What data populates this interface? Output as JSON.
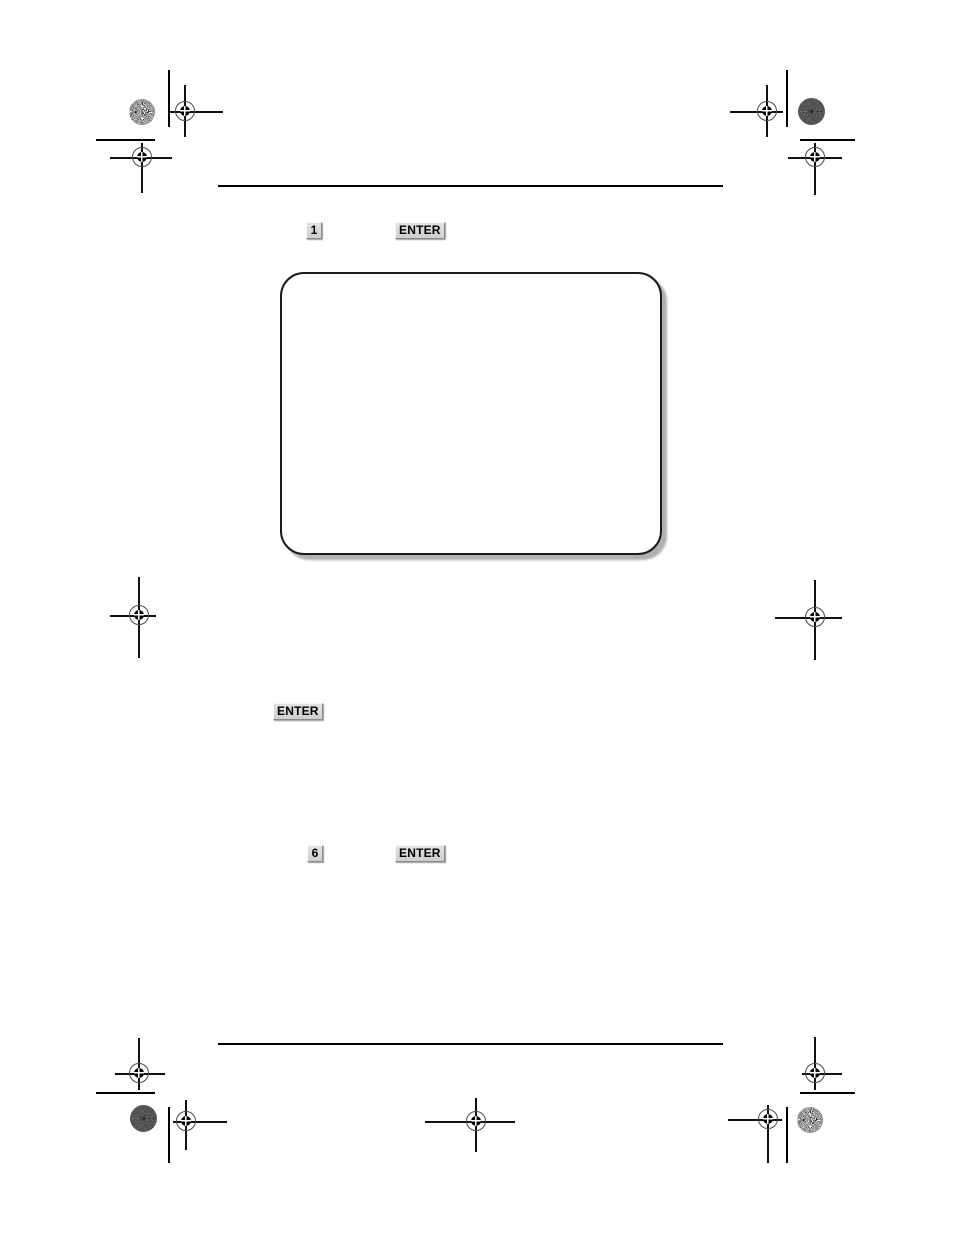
{
  "document": {
    "description": "Blank scanned manual page with print registration marks",
    "keys": {
      "step1_key": "1",
      "step1_enter": "ENTER",
      "inline_enter": "ENTER",
      "step2_key": "6",
      "step2_enter": "ENTER"
    },
    "screen_display": {
      "content": ""
    },
    "colors": {
      "page_background": "#ffffff",
      "line_color": "#101010",
      "key_face": "#d6d6d6",
      "key_text": "#000000",
      "screen_border": "#1a1a1a",
      "screen_shadow": "#b0b0b0",
      "star_target_light": "#ececec",
      "star_target_dark": "#5a5a5a"
    }
  }
}
